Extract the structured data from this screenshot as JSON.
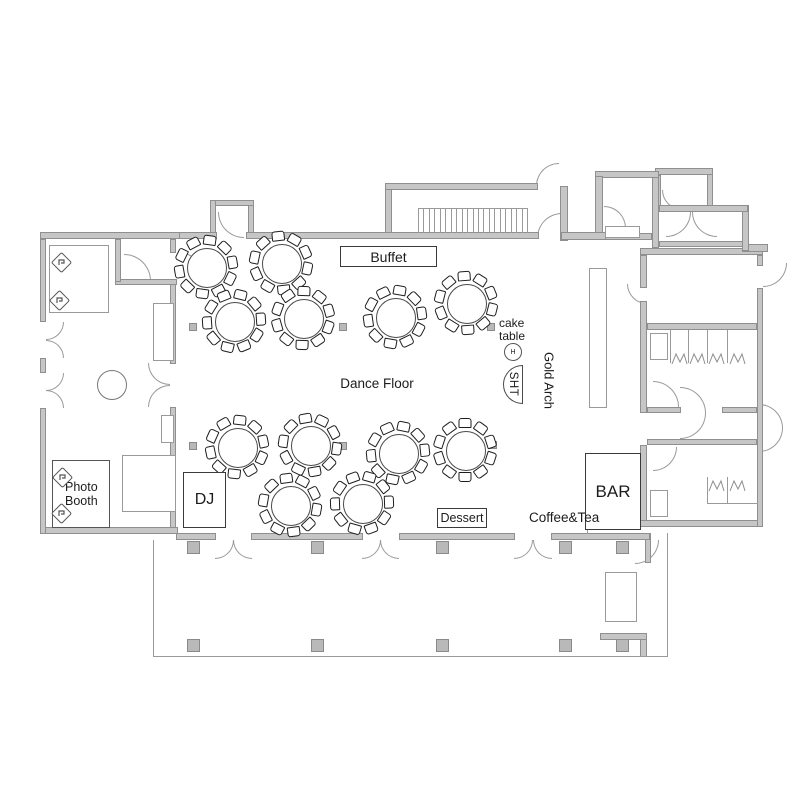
{
  "labels": {
    "buffet": "Buffet",
    "dance_floor": "Dance Floor",
    "cake_table": "cake table",
    "cake_stand_monogram": "H",
    "sht": "SHT",
    "gold_arch": "Gold Arch",
    "dj": "DJ",
    "photo_booth": "Photo Booth",
    "bar": "BAR",
    "dessert": "Dessert",
    "coffee_tea": "Coffee&Tea"
  },
  "floorplan": {
    "colors": {
      "wall_fill": "#c6c6c6",
      "wall_edge": "#8f8f8f",
      "thin": "#9a9a9a",
      "furniture": "#1d1d1d",
      "text": "#1c1c1c"
    },
    "walls": [
      [
        40,
        232,
        140,
        7
      ],
      [
        176,
        232,
        41,
        7
      ],
      [
        246,
        232,
        293,
        7
      ],
      [
        561,
        232,
        45,
        8
      ],
      [
        40,
        239,
        6,
        83
      ],
      [
        40,
        358,
        6,
        15
      ],
      [
        40,
        408,
        6,
        126
      ],
      [
        40,
        527,
        138,
        7
      ],
      [
        115,
        239,
        6,
        43
      ],
      [
        115,
        279,
        62,
        6
      ],
      [
        170,
        239,
        6,
        14
      ],
      [
        170,
        280,
        6,
        84
      ],
      [
        170,
        407,
        6,
        127
      ],
      [
        176,
        533,
        40,
        7
      ],
      [
        251,
        533,
        112,
        7
      ],
      [
        399,
        533,
        116,
        7
      ],
      [
        551,
        533,
        99,
        7
      ],
      [
        210,
        200,
        6,
        34
      ],
      [
        210,
        200,
        44,
        6
      ],
      [
        248,
        200,
        6,
        34
      ],
      [
        385,
        183,
        153,
        7
      ],
      [
        385,
        187,
        7,
        49
      ],
      [
        560,
        186,
        8,
        55
      ],
      [
        595,
        176,
        8,
        64
      ],
      [
        595,
        171,
        64,
        7
      ],
      [
        652,
        171,
        7,
        77
      ],
      [
        659,
        205,
        89,
        7
      ],
      [
        742,
        205,
        7,
        46
      ],
      [
        659,
        241,
        90,
        6
      ],
      [
        742,
        244,
        26,
        8
      ],
      [
        602,
        233,
        50,
        7
      ],
      [
        640,
        248,
        123,
        7
      ],
      [
        757,
        255,
        6,
        11
      ],
      [
        757,
        288,
        6,
        239
      ],
      [
        640,
        520,
        123,
        7
      ],
      [
        640,
        255,
        7,
        33
      ],
      [
        640,
        301,
        7,
        112
      ],
      [
        640,
        445,
        7,
        82
      ],
      [
        647,
        323,
        110,
        7
      ],
      [
        647,
        407,
        34,
        6
      ],
      [
        722,
        407,
        35,
        6
      ],
      [
        647,
        439,
        110,
        6
      ],
      [
        645,
        533,
        6,
        30
      ],
      [
        655,
        168,
        58,
        7
      ],
      [
        707,
        168,
        6,
        44
      ],
      [
        655,
        175,
        6,
        33
      ],
      [
        600,
        633,
        47,
        7
      ],
      [
        640,
        633,
        7,
        24
      ]
    ],
    "windows": [
      [
        68,
        233,
        26,
        5
      ],
      [
        95,
        528,
        36,
        5
      ]
    ],
    "thin_rects": [
      [
        49,
        245,
        60,
        68
      ],
      [
        153,
        303,
        21,
        58
      ],
      [
        161,
        415,
        13,
        28
      ],
      [
        589,
        268,
        18,
        140
      ],
      [
        650,
        333,
        18,
        27
      ],
      [
        650,
        490,
        18,
        27
      ],
      [
        605,
        572,
        32,
        50
      ],
      [
        611,
        578,
        20,
        38
      ],
      [
        605,
        226,
        35,
        12
      ]
    ],
    "lines": [
      [
        153,
        540,
        1,
        117
      ],
      [
        153,
        656,
        515,
        1
      ],
      [
        667,
        533,
        1,
        124
      ],
      [
        670,
        330,
        1,
        33
      ],
      [
        688,
        330,
        1,
        33
      ],
      [
        707,
        330,
        1,
        33
      ],
      [
        727,
        330,
        1,
        33
      ],
      [
        707,
        477,
        1,
        27
      ],
      [
        727,
        477,
        1,
        27
      ],
      [
        707,
        503,
        51,
        1
      ],
      [
        587,
        508,
        1,
        26
      ],
      [
        388,
        247,
        1,
        20
      ]
    ],
    "hall_columns": [
      [
        193,
        327
      ],
      [
        343,
        327
      ],
      [
        491,
        327
      ],
      [
        193,
        446
      ],
      [
        343,
        446
      ],
      [
        493,
        445
      ]
    ],
    "deck_columns": [
      [
        193,
        547
      ],
      [
        317,
        547
      ],
      [
        442,
        547
      ],
      [
        565,
        547
      ],
      [
        622,
        547
      ],
      [
        193,
        645
      ],
      [
        317,
        645
      ],
      [
        442,
        645
      ],
      [
        565,
        645
      ],
      [
        622,
        645
      ]
    ],
    "arcs": [
      [
        124,
        254,
        27,
        "tr"
      ],
      [
        178,
        252,
        27,
        "tr"
      ],
      [
        218,
        212,
        26,
        "bl"
      ],
      [
        537,
        213,
        25,
        "tl"
      ],
      [
        536,
        163,
        23,
        "tl"
      ],
      [
        604,
        206,
        22,
        "tr"
      ],
      [
        666,
        212,
        25,
        "br"
      ],
      [
        692,
        212,
        25,
        "bl"
      ],
      [
        763,
        263,
        24,
        "br"
      ],
      [
        627,
        284,
        20,
        "bl"
      ],
      [
        148,
        363,
        22,
        "bl"
      ],
      [
        148,
        385,
        22,
        "tl"
      ],
      [
        46,
        322,
        18,
        "br"
      ],
      [
        46,
        340,
        18,
        "tr"
      ],
      [
        46,
        373,
        18,
        "br"
      ],
      [
        46,
        390,
        18,
        "tr"
      ],
      [
        215,
        540,
        19,
        "br"
      ],
      [
        233,
        540,
        19,
        "bl"
      ],
      [
        362,
        540,
        19,
        "br"
      ],
      [
        380,
        540,
        19,
        "bl"
      ],
      [
        514,
        540,
        19,
        "br"
      ],
      [
        533,
        540,
        19,
        "bl"
      ],
      [
        635,
        540,
        24,
        "br"
      ],
      [
        680,
        387,
        26,
        "tr"
      ],
      [
        680,
        413,
        26,
        "br"
      ],
      [
        759,
        404,
        24,
        "tr"
      ],
      [
        759,
        428,
        24,
        "br"
      ],
      [
        653,
        447,
        24,
        "br"
      ],
      [
        653,
        381,
        26,
        "tr"
      ],
      [
        662,
        190,
        20,
        "bl"
      ]
    ],
    "toilets": [
      [
        671,
        352
      ],
      [
        689,
        352
      ],
      [
        708,
        352
      ],
      [
        729,
        352
      ],
      [
        708,
        479
      ],
      [
        729,
        479
      ]
    ],
    "tables": [
      [
        206,
        267,
        8
      ],
      [
        281,
        263,
        -6
      ],
      [
        234,
        321,
        14
      ],
      [
        303,
        318,
        2
      ],
      [
        395,
        317,
        10
      ],
      [
        466,
        303,
        -4
      ],
      [
        237,
        447,
        6
      ],
      [
        310,
        445,
        -10
      ],
      [
        398,
        453,
        12
      ],
      [
        465,
        450,
        0
      ],
      [
        290,
        505,
        -8
      ],
      [
        362,
        503,
        16
      ]
    ],
    "table_style": {
      "radius": 19,
      "chairs": 10,
      "ring": 27
    },
    "lobby_table": {
      "x": 97,
      "y": 370,
      "d": 30
    },
    "cake_stand": {
      "x": 504,
      "y": 343,
      "d": 18
    },
    "sht_table": {
      "x": 503,
      "y": 365,
      "w": 20,
      "h": 39
    },
    "stairs_vestibule": {
      "x": 418,
      "y": 208,
      "w": 109,
      "h": 25,
      "count": 21
    },
    "stairs_annex": {
      "x": 122,
      "y": 455,
      "w": 54,
      "h": 57,
      "step": 6
    },
    "camera_icons": [
      [
        54,
        255
      ],
      [
        52,
        293
      ],
      [
        55,
        470
      ],
      [
        54,
        506
      ]
    ]
  }
}
